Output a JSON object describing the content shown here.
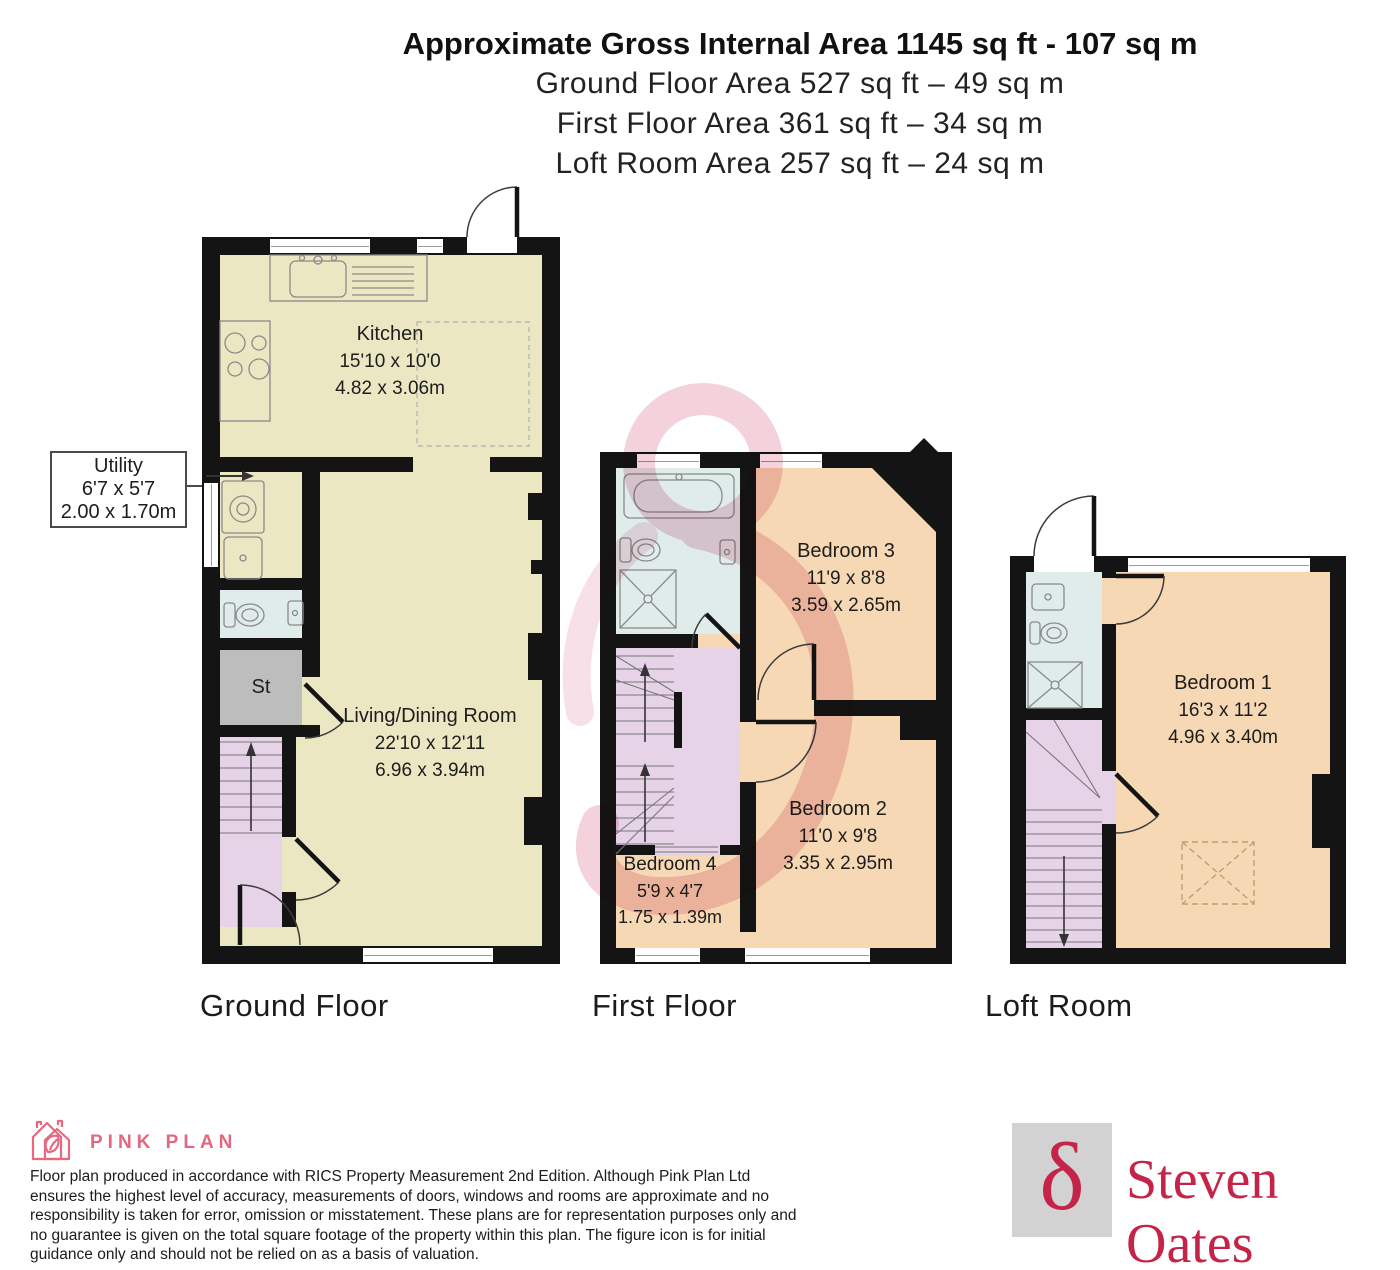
{
  "header": {
    "title": "Approximate Gross Internal Area 1145 sq ft - 107 sq m",
    "subtitles": [
      "Ground Floor Area 527 sq ft – 49 sq m",
      "First Floor Area 361 sq ft – 34 sq m",
      "Loft Room Area 257 sq ft – 24 sq m"
    ]
  },
  "floors": [
    {
      "caption": "Ground Floor",
      "rooms": [
        {
          "name": "Kitchen",
          "imperial": "15'10 x 10'0",
          "metric": "4.82 x 3.06m"
        },
        {
          "name": "Living/Dining Room",
          "imperial": "22'10 x 12'11",
          "metric": "6.96 x 3.94m"
        },
        {
          "name": "St"
        }
      ],
      "callout": {
        "name": "Utility",
        "imperial": "6'7 x 5'7",
        "metric": "2.00 x 1.70m"
      }
    },
    {
      "caption": "First Floor",
      "rooms": [
        {
          "name": "Bedroom 3",
          "imperial": "11'9 x 8'8",
          "metric": "3.59 x 2.65m"
        },
        {
          "name": "Bedroom 2",
          "imperial": "11'0 x 9'8",
          "metric": "3.35 x 2.95m"
        },
        {
          "name": "Bedroom 4",
          "imperial": "5'9 x 4'7",
          "metric": "1.75 x 1.39m"
        }
      ]
    },
    {
      "caption": "Loft Room",
      "rooms": [
        {
          "name": "Bedroom 1",
          "imperial": "16'3 x 11'2",
          "metric": "4.96 x 3.40m"
        }
      ]
    }
  ],
  "footer": {
    "brand": "PINK PLAN",
    "disclaimer": "Floor plan produced in accordance with RICS Property Measurement 2nd Edition. Although Pink Plan Ltd ensures the highest level of accuracy, measurements of doors, windows and rooms are approximate and no responsibility is taken for error, omission or misstatement. These plans are for representation purposes only and no guarantee is given on the total square footage of the property within this plan. The figure icon is for initial guidance only and should not be relied on as a basis of valuation.",
    "agency": "Steven Oates",
    "delta_glyph": "δ"
  },
  "colors": {
    "wall": "#141414",
    "kitchen_living": "#ece7c3",
    "bedroom": "#f7d8b4",
    "bathroom": "#dfecea",
    "stairs": "#e6d3e8",
    "storage": "#bdbdbd",
    "brand_pink": "#e4677f",
    "agency_crimson": "#c52449",
    "watermark_pink": "#f2cdd9"
  }
}
